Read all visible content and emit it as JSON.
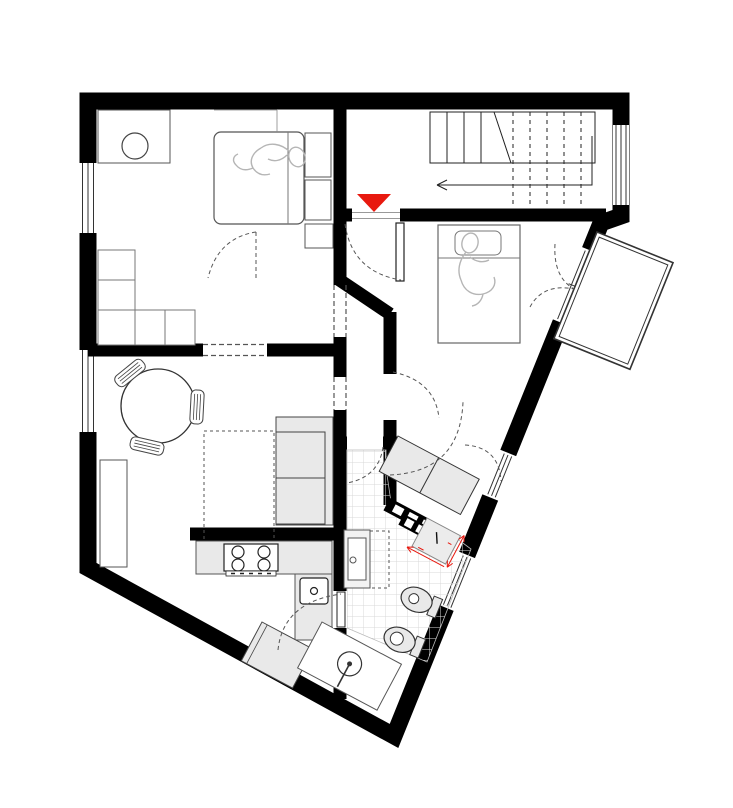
{
  "title": "apartment floor plan",
  "colors": {
    "wall": "#000000",
    "accent_red": "#e8190f",
    "furniture_fill": "#e9e9e9",
    "thin_line": "#444444",
    "tile_line": "#d9d9d9",
    "person_line": "#b5b5b5",
    "dash_line": "#555555",
    "paper": "#ffffff"
  },
  "entrance": {
    "marker": "red-triangle-pointing-down"
  },
  "stairwell": {
    "flights": 2,
    "arrow_direction": "left",
    "tread_style": "solid-above-cut, dashed-below"
  },
  "rooms": [
    {
      "name": "bedroom-1",
      "furniture": [
        "double-bed",
        "sleeping-person",
        "desk",
        "stool",
        "wardrobe-cells",
        "nightstands"
      ]
    },
    {
      "name": "stair-hall",
      "furniture": [
        "u-stair",
        "direction-arrow"
      ]
    },
    {
      "name": "bedroom-2",
      "furniture": [
        "single-bed",
        "sleeping-person",
        "balcony-french-door"
      ]
    },
    {
      "name": "living-room",
      "furniture": [
        "round-table",
        "three-chairs",
        "rug",
        "sofa",
        "sideboard"
      ]
    },
    {
      "name": "kitchen",
      "furniture": [
        "counter",
        "stove-4-burners",
        "sink",
        "washer"
      ]
    },
    {
      "name": "bathroom",
      "furniture": [
        "vanity",
        "mirror-cabinet-dashed",
        "bidet",
        "toilet",
        "shower"
      ]
    },
    {
      "name": "nook",
      "furniture": [
        "desk-two-seats",
        "notched-partition",
        "appliance-with-red-dimensions"
      ]
    },
    {
      "name": "balcony",
      "furniture": []
    }
  ]
}
